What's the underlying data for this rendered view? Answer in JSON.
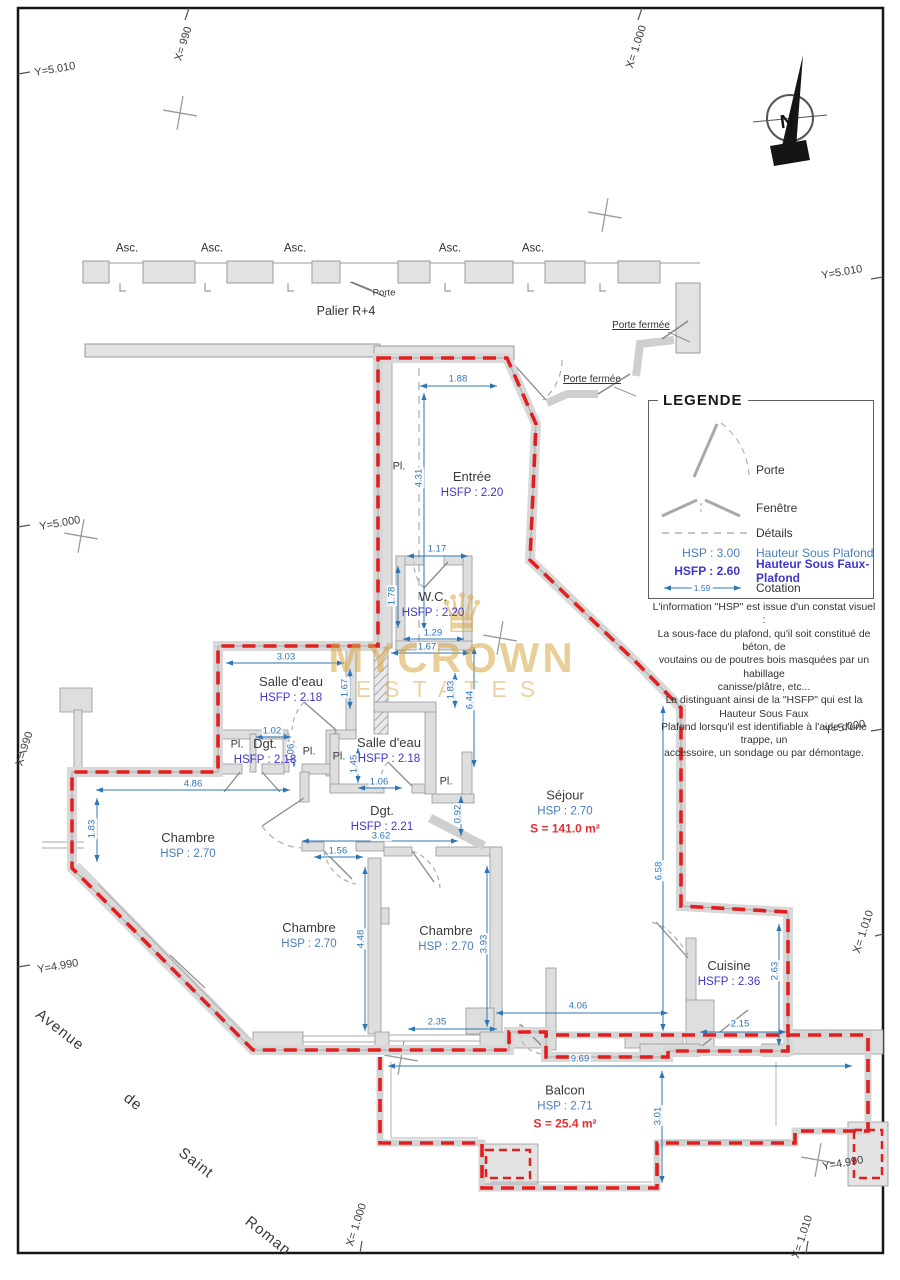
{
  "compass": {
    "letter": "N"
  },
  "corridor": {
    "asc_labels": [
      {
        "text": "Asc.",
        "x": 127,
        "y": 249
      },
      {
        "text": "Asc.",
        "x": 212,
        "y": 249
      },
      {
        "text": "Asc.",
        "x": 295,
        "y": 249
      },
      {
        "text": "Asc.",
        "x": 450,
        "y": 249
      },
      {
        "text": "Asc.",
        "x": 533,
        "y": 249
      }
    ],
    "porte": "Porte",
    "palier": "Palier R+4",
    "porte_fermee_top": "Porte fermée",
    "porte_fermee_bottom": "Porte fermée"
  },
  "grid_labels": [
    {
      "text": "Y=5.010",
      "x": 55,
      "y": 70,
      "rot": -10
    },
    {
      "text": "X= 990",
      "x": 184,
      "y": 44,
      "rot": -72
    },
    {
      "text": "X= 1.000",
      "x": 637,
      "y": 47,
      "rot": -72
    },
    {
      "text": "Y=5.010",
      "x": 842,
      "y": 273,
      "rot": -10
    },
    {
      "text": "Y=5.000",
      "x": 60,
      "y": 524,
      "rot": -10
    },
    {
      "text": "Y=5.000",
      "x": 845,
      "y": 728,
      "rot": -10
    },
    {
      "text": "X= 990",
      "x": 25,
      "y": 749,
      "rot": -72
    },
    {
      "text": "X= 1.010",
      "x": 864,
      "y": 932,
      "rot": -72
    },
    {
      "text": "Y=4.990",
      "x": 58,
      "y": 967,
      "rot": -10
    },
    {
      "text": "Y=4.990",
      "x": 843,
      "y": 1164,
      "rot": -10
    },
    {
      "text": "X= 1.000",
      "x": 357,
      "y": 1225,
      "rot": -72
    },
    {
      "text": "X= 1.010",
      "x": 803,
      "y": 1237,
      "rot": -72
    }
  ],
  "rooms": [
    {
      "name": "Entrée",
      "height": "HSFP : 2.20",
      "height_cls": "hsfp",
      "x": 472,
      "y": 485
    },
    {
      "name": "W.C.",
      "height": "HSFP : 2.20",
      "height_cls": "hsfp",
      "x": 433,
      "y": 605
    },
    {
      "name": "Salle d'eau",
      "height": "HSFP : 2.18",
      "height_cls": "hsfp",
      "x": 291,
      "y": 690
    },
    {
      "name": "Dgt.",
      "height": "HSFP : 2.18",
      "height_cls": "hsfp",
      "x": 265,
      "y": 752
    },
    {
      "name": "Salle d'eau",
      "height": "HSFP : 2.18",
      "height_cls": "hsfp",
      "x": 389,
      "y": 751
    },
    {
      "name": "Dgt.",
      "height": "HSFP : 2.21",
      "height_cls": "hsfp",
      "x": 382,
      "y": 819
    },
    {
      "name": "Chambre",
      "height": "HSP : 2.70",
      "height_cls": "hsp",
      "x": 188,
      "y": 846
    },
    {
      "name": "Chambre",
      "height": "HSP : 2.70",
      "height_cls": "hsp",
      "x": 309,
      "y": 936
    },
    {
      "name": "Chambre",
      "height": "HSP : 2.70",
      "height_cls": "hsp",
      "x": 446,
      "y": 939
    },
    {
      "name": "Séjour",
      "height": "HSP : 2.70",
      "height_cls": "hsp",
      "area": "S = 141.0 m²",
      "x": 565,
      "y": 812
    },
    {
      "name": "Cuisine",
      "height": "HSFP : 2.36",
      "height_cls": "hsfp",
      "x": 729,
      "y": 974
    },
    {
      "name": "Balcon",
      "height": "HSP : 2.71",
      "height_cls": "hsp",
      "area": "S = 25.4 m²",
      "x": 565,
      "y": 1107
    }
  ],
  "closet_labels": [
    {
      "text": "Pl.",
      "x": 399,
      "y": 467
    },
    {
      "text": "Pl.",
      "x": 237,
      "y": 745
    },
    {
      "text": "Pl.",
      "x": 309,
      "y": 752
    },
    {
      "text": "Pl.",
      "x": 339,
      "y": 757
    },
    {
      "text": "Pl.",
      "x": 446,
      "y": 782
    }
  ],
  "dimensions": [
    {
      "text": "1.88",
      "x": 458,
      "y": 379
    },
    {
      "text": "4.31",
      "x": 419,
      "y": 478,
      "rot": -90
    },
    {
      "text": "1.17",
      "x": 437,
      "y": 549
    },
    {
      "text": "1.78",
      "x": 392,
      "y": 596,
      "rot": -90
    },
    {
      "text": "1.29",
      "x": 433,
      "y": 633
    },
    {
      "text": "1.67",
      "x": 427,
      "y": 647
    },
    {
      "text": "3.03",
      "x": 286,
      "y": 657
    },
    {
      "text": "1.67",
      "x": 345,
      "y": 688,
      "rot": -90
    },
    {
      "text": "1.02",
      "x": 272,
      "y": 731
    },
    {
      "text": "1.06",
      "x": 291,
      "y": 753,
      "rot": -90
    },
    {
      "text": "1.45",
      "x": 354,
      "y": 764,
      "rot": -90
    },
    {
      "text": "1.06",
      "x": 379,
      "y": 782
    },
    {
      "text": "1.83",
      "x": 451,
      "y": 690,
      "rot": -90
    },
    {
      "text": "6.44",
      "x": 470,
      "y": 700,
      "rot": -90
    },
    {
      "text": "4.86",
      "x": 193,
      "y": 784
    },
    {
      "text": "1.83",
      "x": 92,
      "y": 829,
      "rot": -90
    },
    {
      "text": "3.62",
      "x": 381,
      "y": 836
    },
    {
      "text": "1.56",
      "x": 338,
      "y": 851
    },
    {
      "text": "0.92",
      "x": 458,
      "y": 814,
      "rot": -90
    },
    {
      "text": "4.48",
      "x": 361,
      "y": 939,
      "rot": -90
    },
    {
      "text": "3.93",
      "x": 484,
      "y": 944,
      "rot": -90
    },
    {
      "text": "2.35",
      "x": 437,
      "y": 1022
    },
    {
      "text": "4.06",
      "x": 578,
      "y": 1006
    },
    {
      "text": "6.58",
      "x": 659,
      "y": 871,
      "rot": -90
    },
    {
      "text": "2.63",
      "x": 775,
      "y": 971,
      "rot": -90
    },
    {
      "text": "2.15",
      "x": 740,
      "y": 1024
    },
    {
      "text": "9.69",
      "x": 580,
      "y": 1059
    },
    {
      "text": "3.01",
      "x": 658,
      "y": 1116,
      "rot": -90
    }
  ],
  "legend": {
    "title": "LEGENDE",
    "porte": "Porte",
    "fenetre": "Fenêtre",
    "details": "Détails",
    "hsp_key": "HSP : 3.00",
    "hsp_label": "Hauteur Sous Plafond",
    "hsfp_key": "HSFP : 2.60",
    "hsfp_label": "Hauteur Sous Faux-Plafond",
    "cotation_value": "1.59",
    "cotation_label": "Cotation",
    "note": "L'information \"HSP\" est issue d'un constat visuel :\nLa sous-face du plafond, qu'il soit constitué de béton, de\nvoutains ou de poutres bois masquées par un habillage\ncanisse/plâtre, etc...\nLa distinguant ainsi de la \"HSFP\" qui est la Hauteur Sous Faux\nPlafond lorsqu'il est identifiable à l'aide d'une trappe, un\naccessoire, un sondage ou par démontage."
  },
  "street_words": [
    {
      "text": "Avenue",
      "x": 60,
      "y": 1030,
      "rot": 38
    },
    {
      "text": "de",
      "x": 133,
      "y": 1102,
      "rot": 38
    },
    {
      "text": "Saint",
      "x": 196,
      "y": 1163,
      "rot": 38
    },
    {
      "text": "Roman",
      "x": 268,
      "y": 1236,
      "rot": 38
    }
  ],
  "watermark": {
    "crown": "♛",
    "line1": "MYCROWN",
    "line2": "ESTATES"
  },
  "colors": {
    "boundary": "#e11f1f",
    "dimension": "#2e75b6",
    "hsp": "#4a7ebb",
    "hsfp": "#3f37c9",
    "area": "#e03030",
    "wall": "#d9d9d9",
    "watermark": "#d7a843"
  }
}
